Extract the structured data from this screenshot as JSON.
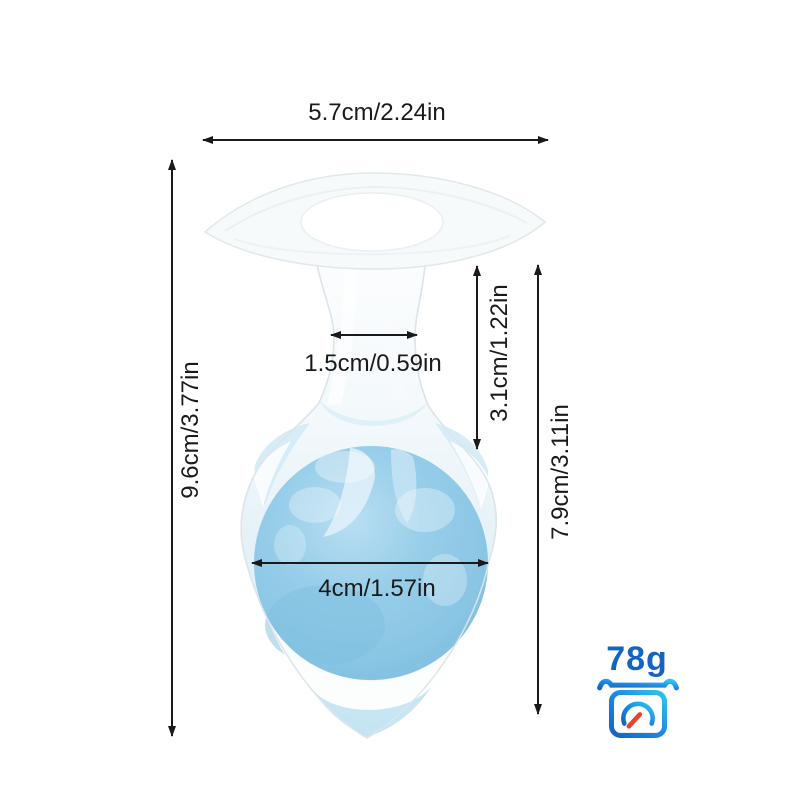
{
  "background": "#FFFFFF",
  "annotations": {
    "color": "#1A1A1A",
    "top_width": "5.7cm/2.24in",
    "overall_height": "9.6cm/3.77in",
    "neck_width": "1.5cm/0.59in",
    "upper_section_height": "3.1cm/1.22in",
    "lower_section_height": "7.9cm/3.11in",
    "ball_diameter": "4cm/1.57in"
  },
  "weight": {
    "value": "78g",
    "icon": "weighing-scale-icon",
    "text_color": "#1565C0",
    "icon_colors": {
      "gradient_start": "#1565C0",
      "gradient_mid": "#1E88E5",
      "gradient_end": "#29C8F0",
      "needle": "#E8412F"
    }
  },
  "product": {
    "description": "transparent silicone flared-top product with blue gel ball inside",
    "colors": {
      "ball": "#8AC6E4",
      "ball_highlight": "#B9DEF2",
      "shell_tint": "#D8ECF7",
      "outline": "#DCE5E9"
    }
  }
}
